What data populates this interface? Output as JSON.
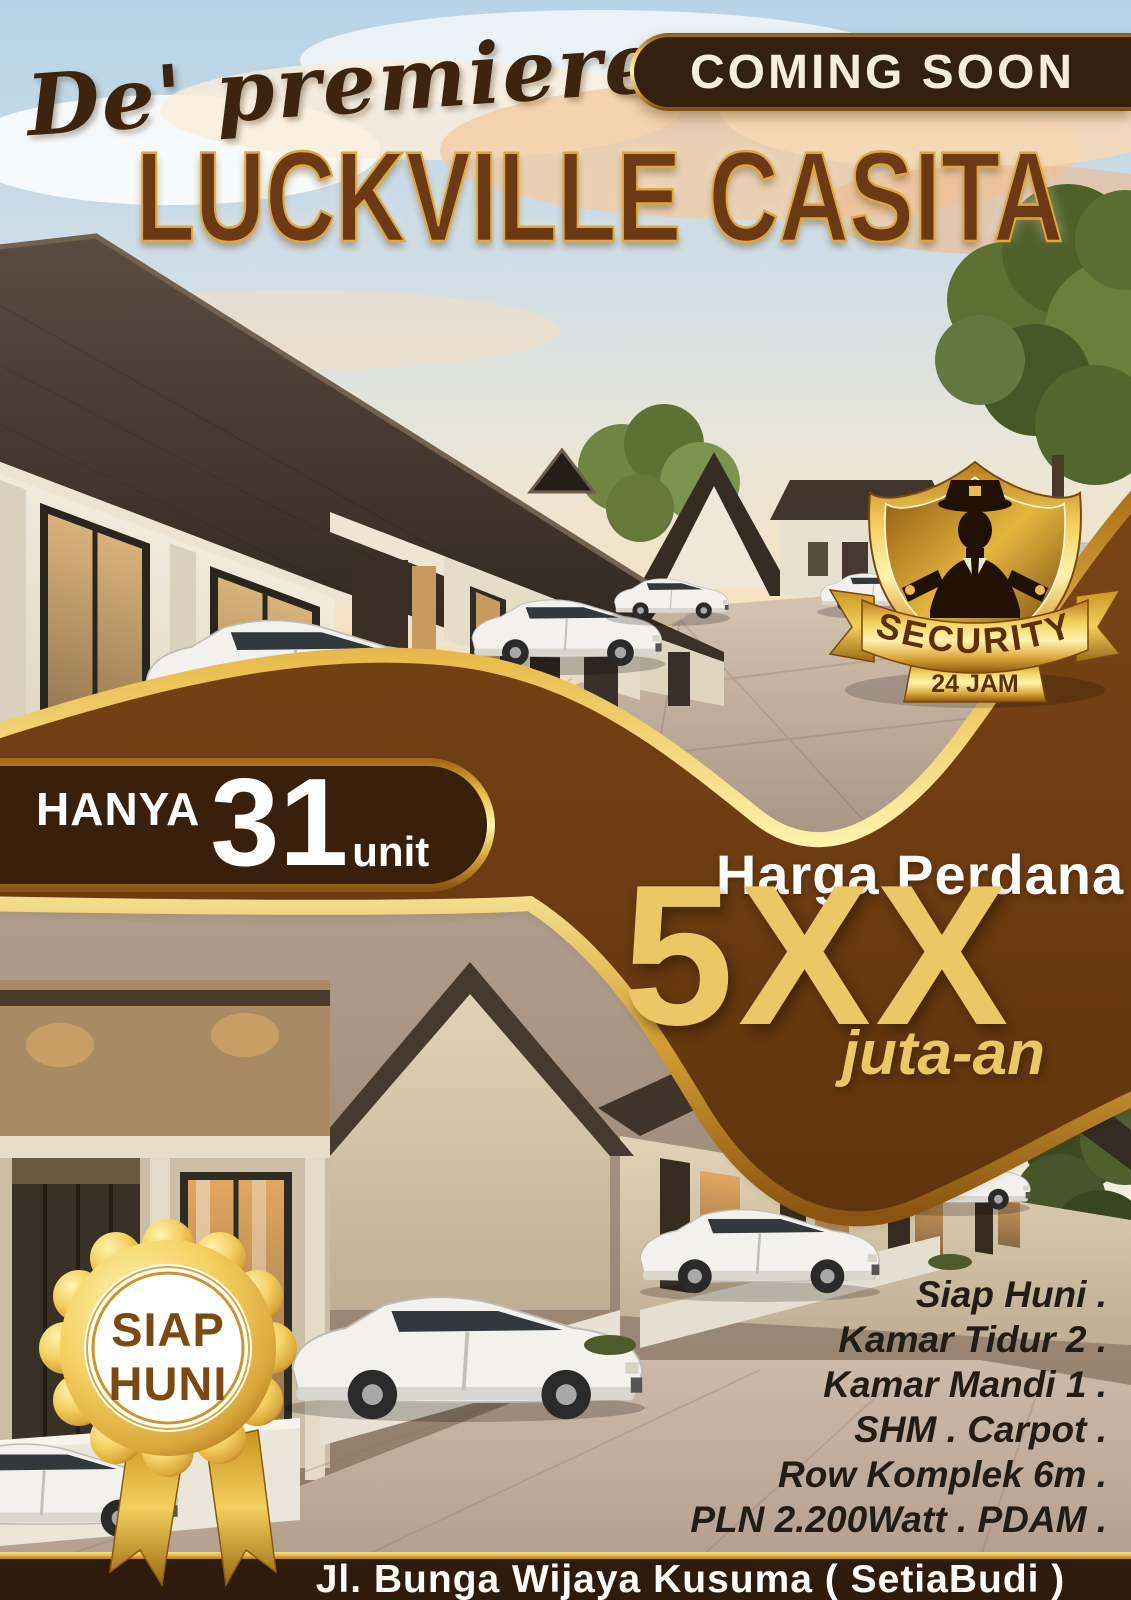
{
  "header": {
    "script_brand": "De' premiere",
    "coming_soon_label": "COMING SOON",
    "project_title": "LUCKVILLE CASITA"
  },
  "security_badge": {
    "title": "SECURITY",
    "subtitle": "24 JAM"
  },
  "units_banner": {
    "prefix": "HANYA",
    "count": "31",
    "unit_label": "unit"
  },
  "price_block": {
    "label": "Harga Perdana",
    "value": "5XX",
    "suffix": "juta-an"
  },
  "ready_badge": {
    "top": "SIAP",
    "bottom": "HUNI"
  },
  "features": [
    "Siap Huni .",
    "Kamar Tidur 2 .",
    "Kamar Mandi 1 .",
    "SHM . Carpot .",
    "Row Komplek 6m .",
    "PLN 2.200Watt . PDAM ."
  ],
  "footer": {
    "address": "Jl. Bunga Wijaya Kusuma ( SetiaBudi )"
  },
  "colors": {
    "swoosh_brown": "#6e3d12",
    "dark_brown": "#311d0c",
    "gold": "#e4b64a",
    "gold_light": "#fff3ae",
    "gold_deep": "#a06a14",
    "price_gold": "#ebc765",
    "cream_text": "#f6eedb",
    "title_brown": "#6b3a14"
  }
}
